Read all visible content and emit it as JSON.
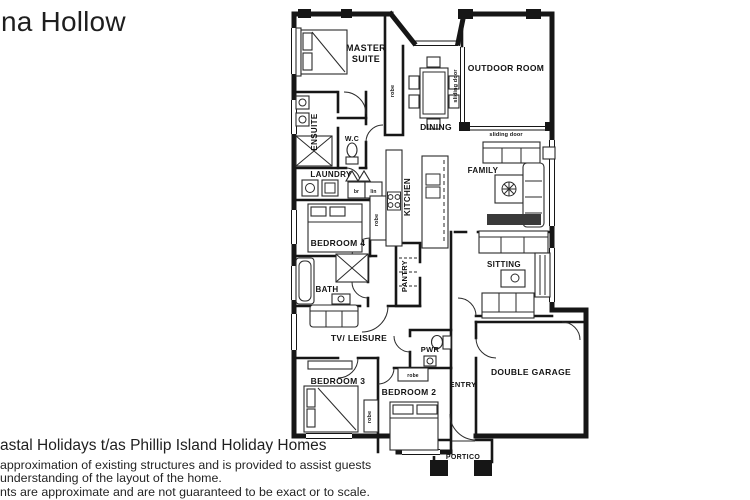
{
  "title": "na Hollow",
  "footer": {
    "company": "astal Holidays t/as Phillip Island Holiday Homes",
    "disclaimer1": "approximation of existing structures and is provided to assist guests",
    "disclaimer2": "understanding of the layout of the home.",
    "disclaimer3": "nts are approximate and are not guaranteed to be exact or to scale."
  },
  "floorplan": {
    "rooms": {
      "master1": "MASTER",
      "master2": "SUITE",
      "outdoor": "OUTDOOR ROOM",
      "ensuite": "ENSUITE",
      "wc": "W.C",
      "dining": "DINING",
      "family": "FAMILY",
      "laundry": "LAUNDRY",
      "kitchen": "KITCHEN",
      "bedroom4": "BEDROOM 4",
      "bath": "BATH",
      "pantry": "PANTRY",
      "sitting": "SITTING",
      "tv_leisure": "TV/ LEISURE",
      "pwr": "PWR",
      "bedroom3": "BEDROOM 3",
      "bedroom2": "BEDROOM 2",
      "entry": "ENTRY",
      "garage": "DOUBLE GARAGE",
      "portico": "PORTICO"
    },
    "annotations": {
      "robe": "robe",
      "sliding_door": "sliding door",
      "br": "br",
      "lin": "lin"
    },
    "colors": {
      "ink": "#161616",
      "paper": "#ffffff"
    }
  }
}
